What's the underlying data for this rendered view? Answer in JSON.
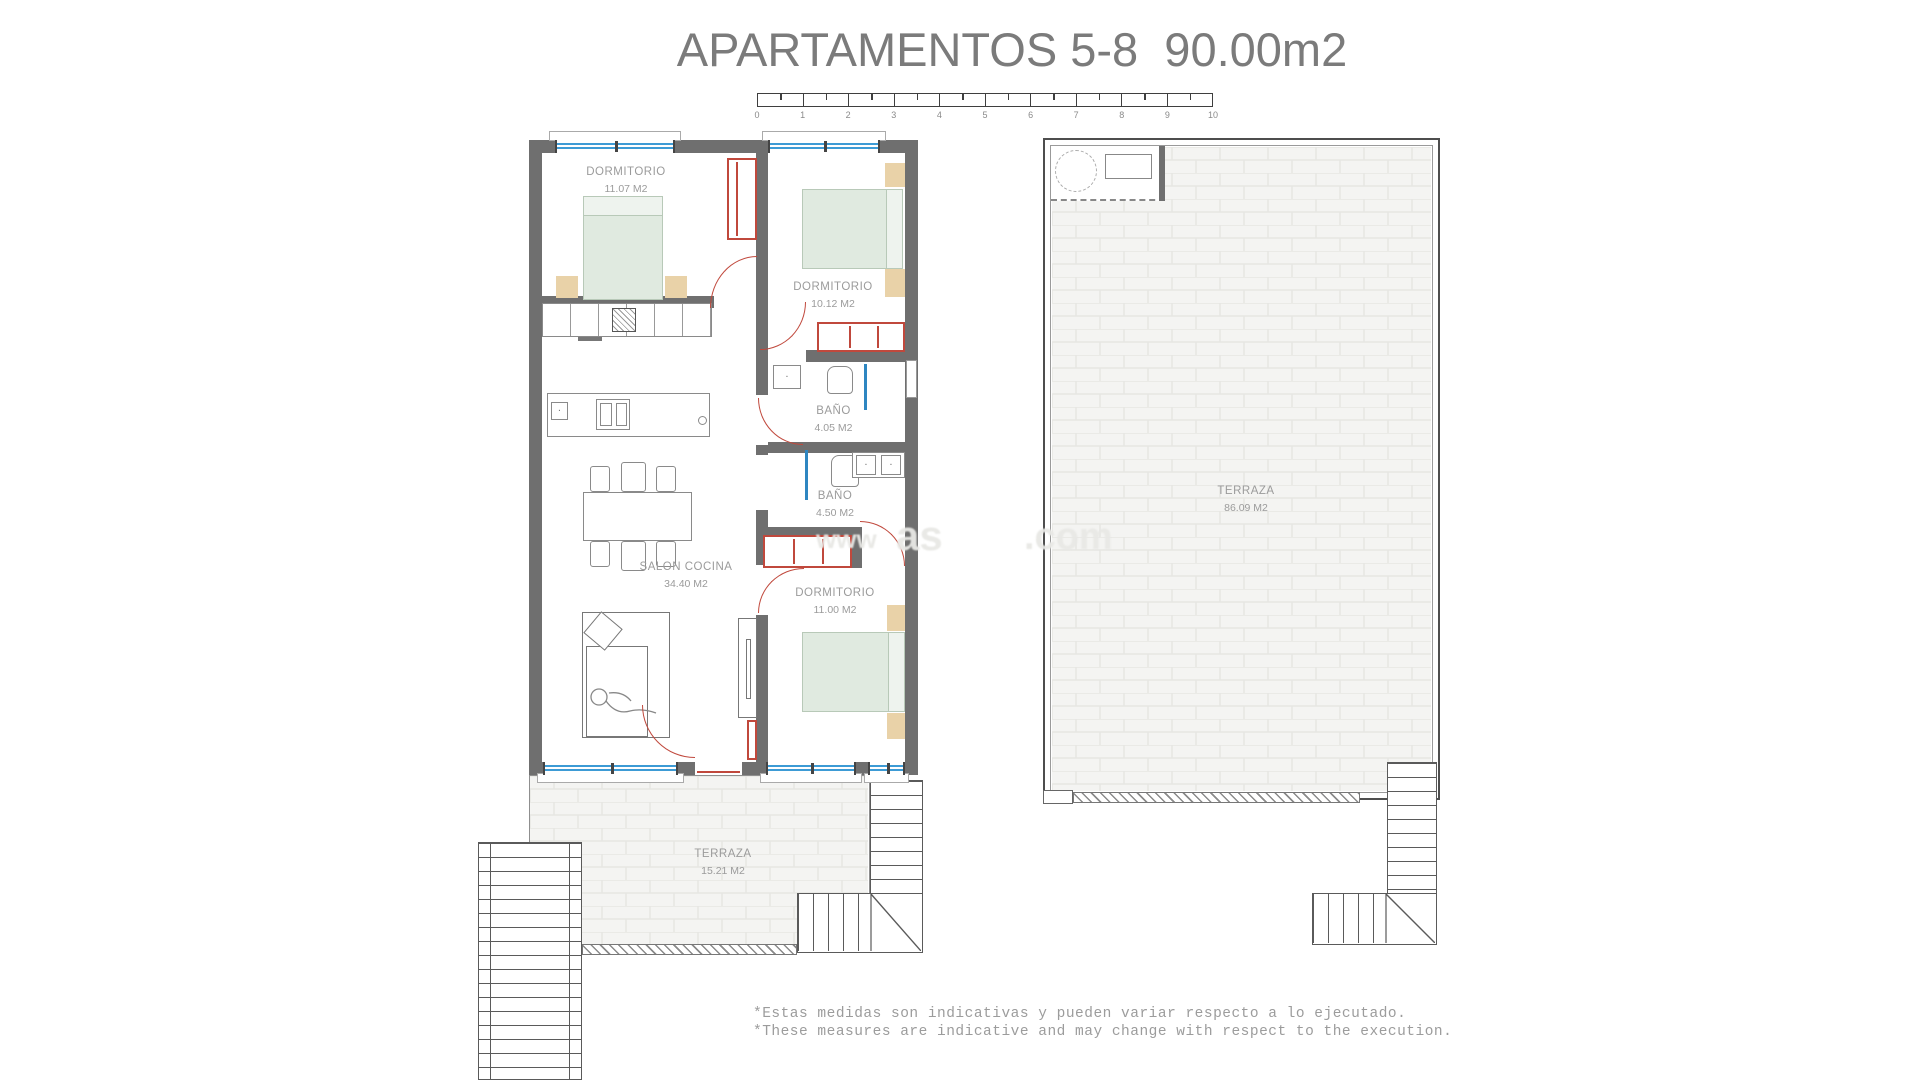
{
  "title": "APARTAMENTOS 5-8  90.00m2",
  "scale_bar": {
    "ticks": [
      "0",
      "1",
      "2",
      "3",
      "4",
      "5",
      "6",
      "7",
      "8",
      "9",
      "10"
    ]
  },
  "rooms": {
    "dormitorio1": {
      "name": "DORMITORIO",
      "area": "11.07 M2"
    },
    "dormitorio2": {
      "name": "DORMITORIO",
      "area": "10.12 M2"
    },
    "bano1": {
      "name": "BAÑO",
      "area": "4.05 M2"
    },
    "bano2": {
      "name": "BAÑO",
      "area": "4.50 M2"
    },
    "salon": {
      "name": "SALON COCINA",
      "area": "34.40 M2"
    },
    "dormitorio3": {
      "name": "DORMITORIO",
      "area": "11.00 M2"
    },
    "terraza_apartment": {
      "name": "TERRAZA",
      "area": "15.21 M2"
    },
    "terraza_solarium": {
      "name": "TERRAZA",
      "area": "86.09 M2"
    }
  },
  "watermark": {
    "fragments": [
      "www",
      "as",
      ".com"
    ]
  },
  "disclaimer": {
    "line_es": "*Estas medidas son indicativas y pueden variar respecto a lo ejecutado.",
    "line_en": "*These measures are indicative and may change with respect to the execution."
  },
  "colors": {
    "wall": "#6f6f6f",
    "window_blue": "#3d9bd5",
    "accent_red": "#c0483c",
    "bed_fill": "#e0eae0",
    "bed_border": "#b8c9b8",
    "wood_tan": "#e9d2a8",
    "brick_fill": "#f4f4f2",
    "brick_line": "#e6e6e3",
    "label_gray": "#9b9b9b",
    "title_gray": "#7b7b7b",
    "text_gray": "#9c9c9c"
  }
}
